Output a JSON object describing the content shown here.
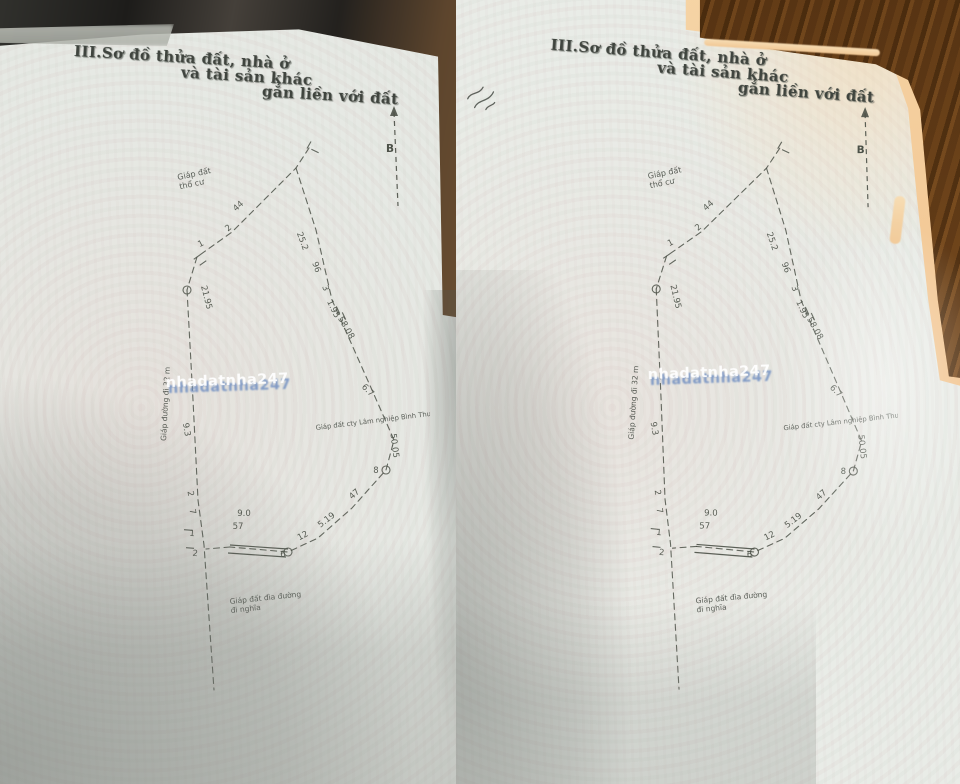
{
  "heading": {
    "parts": [
      "III.Sơ đồ thửa đất, nhà ở",
      "và tài sản khác",
      "gắn liền với đất"
    ]
  },
  "watermark": {
    "text": "nhadatnha247",
    "front_color": "#ffffff",
    "shadow_color": "#7d9cc8"
  },
  "diagram": {
    "stroke_color": "#4c5148",
    "north_label": "B",
    "north_arrow": {
      "x1": 254,
      "y1": 16,
      "x2": 258,
      "y2": 110,
      "label_x": 246,
      "label_y": 56
    },
    "chains": [
      [
        [
          169,
          52
        ],
        [
          156,
          72
        ],
        [
          112,
          116
        ],
        [
          92,
          136
        ],
        [
          57,
          161
        ],
        [
          47,
          194
        ]
      ],
      [
        [
          156,
          72
        ],
        [
          176,
          134
        ],
        [
          192,
          204
        ],
        [
          212,
          249
        ],
        [
          232,
          294
        ],
        [
          254,
          344
        ],
        [
          246,
          374
        ],
        [
          212,
          412
        ],
        [
          178,
          442
        ],
        [
          148,
          456
        ],
        [
          90,
          451
        ]
      ],
      [
        [
          47,
          194
        ],
        [
          53,
          304
        ],
        [
          58,
          404
        ],
        [
          64,
          449
        ],
        [
          74,
          594
        ]
      ],
      [
        [
          90,
          451
        ],
        [
          66,
          453
        ]
      ]
    ],
    "double_lines": [
      [
        [
          90,
          449
        ],
        [
          148,
          453
        ]
      ],
      [
        [
          88,
          457
        ],
        [
          146,
          461
        ]
      ]
    ],
    "circles": [
      [
        47,
        194
      ],
      [
        246,
        374
      ],
      [
        148,
        456
      ]
    ],
    "ticks": [
      [
        169,
        49,
        -60
      ],
      [
        175,
        55,
        25
      ],
      [
        57,
        161,
        -35
      ],
      [
        63,
        167,
        -35
      ],
      [
        48,
        434,
        5
      ],
      [
        50,
        452,
        5
      ],
      [
        198,
        214,
        65
      ],
      [
        204,
        220,
        65
      ]
    ],
    "dimensions": [
      {
        "t": "44",
        "x": 100,
        "y": 112,
        "r": -42
      },
      {
        "t": "2",
        "x": 90,
        "y": 134,
        "r": -40
      },
      {
        "t": "1",
        "x": 62,
        "y": 150,
        "r": -28
      },
      {
        "t": "21.95",
        "x": 64,
        "y": 202,
        "r": 76
      },
      {
        "t": "9.3",
        "x": 44,
        "y": 334,
        "r": 80
      },
      {
        "t": "2",
        "x": 48,
        "y": 398,
        "r": 80
      },
      {
        "t": "7",
        "x": 50,
        "y": 416,
        "r": 80
      },
      {
        "t": "1",
        "x": 52,
        "y": 440,
        "r": 5
      },
      {
        "t": "2",
        "x": 55,
        "y": 460,
        "r": 5
      },
      {
        "t": "25.2",
        "x": 160,
        "y": 146,
        "r": 70
      },
      {
        "t": "96",
        "x": 174,
        "y": 172,
        "r": 70
      },
      {
        "t": "3",
        "x": 183,
        "y": 193,
        "r": 70
      },
      {
        "t": "1.95",
        "x": 191,
        "y": 214,
        "r": 64
      },
      {
        "t": "58.08",
        "x": 204,
        "y": 233,
        "r": 60
      },
      {
        "t": "6.7",
        "x": 226,
        "y": 296,
        "r": 45
      },
      {
        "t": "50.05",
        "x": 252,
        "y": 350,
        "r": 83
      },
      {
        "t": "8",
        "x": 236,
        "y": 377,
        "r": 0
      },
      {
        "t": "47",
        "x": 216,
        "y": 400,
        "r": -42
      },
      {
        "t": "5.19",
        "x": 188,
        "y": 426,
        "r": -38
      },
      {
        "t": "12",
        "x": 164,
        "y": 442,
        "r": -28
      },
      {
        "t": "6",
        "x": 143,
        "y": 461,
        "r": 0
      },
      {
        "t": "9.0",
        "x": 104,
        "y": 420,
        "r": 0
      },
      {
        "t": "57",
        "x": 98,
        "y": 433,
        "r": 0
      }
    ],
    "adjacent_labels": [
      {
        "lines": [
          "Giáp đất",
          "thổ cư"
        ],
        "x": 38,
        "y": 84,
        "r": -12,
        "size": 8
      },
      {
        "lines": [
          "Giáp đất cty Lâm nghiệp Bình Thuận"
        ],
        "x": 176,
        "y": 334,
        "r": -7,
        "size": 6.8
      },
      {
        "lines": [
          "Giáp đất đìa đường",
          "đi nghĩa"
        ],
        "x": 90,
        "y": 508,
        "r": -6,
        "size": 7.5
      },
      {
        "lines": [
          "Giáp đường đi 32 m"
        ],
        "x": 26,
        "y": 345,
        "r": -87,
        "size": 7.5
      }
    ]
  }
}
